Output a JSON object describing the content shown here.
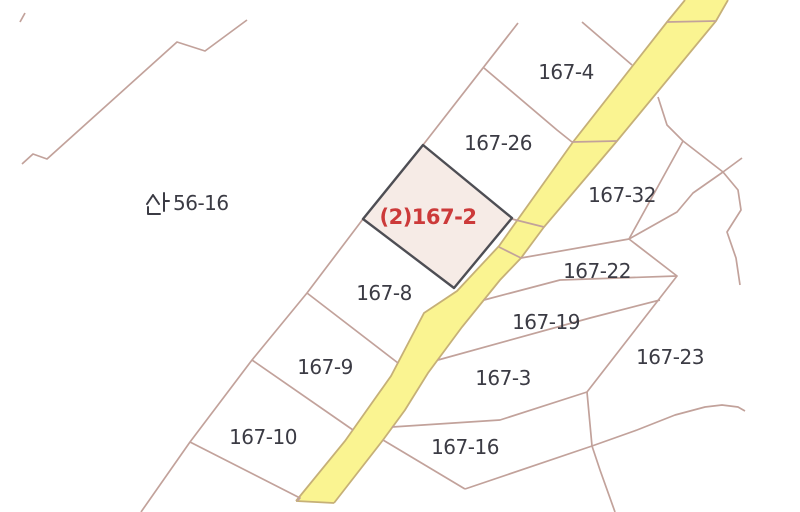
{
  "map": {
    "colors": {
      "background": "#ffffff",
      "parcel_line": "#c2a29b",
      "road_fill": "#faf491",
      "road_edge": "#c6b077",
      "highlight_fill": "#f6ebe6",
      "highlight_border": "#4e4e54",
      "label_text": "#3b3b44",
      "highlight_text": "#cc3a3a"
    },
    "highlight_parcel": {
      "label": "(2)167-2",
      "fill": "#f6ebe6"
    },
    "labels": [
      {
        "text": "167-4",
        "x": 566,
        "y": 72,
        "type": "parcel"
      },
      {
        "text": "167-26",
        "x": 498,
        "y": 143,
        "type": "parcel"
      },
      {
        "text": "산56-16",
        "x": 188,
        "y": 203,
        "type": "mountain"
      },
      {
        "text": "(2)167-2",
        "x": 428,
        "y": 217,
        "type": "highlight"
      },
      {
        "text": "167-32",
        "x": 622,
        "y": 195,
        "type": "parcel"
      },
      {
        "text": "167-22",
        "x": 597,
        "y": 271,
        "type": "parcel"
      },
      {
        "text": "167-8",
        "x": 384,
        "y": 293,
        "type": "parcel"
      },
      {
        "text": "167-19",
        "x": 546,
        "y": 322,
        "type": "parcel"
      },
      {
        "text": "167-23",
        "x": 670,
        "y": 357,
        "type": "parcel"
      },
      {
        "text": "167-9",
        "x": 325,
        "y": 367,
        "type": "parcel"
      },
      {
        "text": "167-3",
        "x": 503,
        "y": 378,
        "type": "parcel"
      },
      {
        "text": "167-16",
        "x": 465,
        "y": 447,
        "type": "parcel"
      },
      {
        "text": "167-10",
        "x": 263,
        "y": 437,
        "type": "parcel"
      }
    ]
  }
}
